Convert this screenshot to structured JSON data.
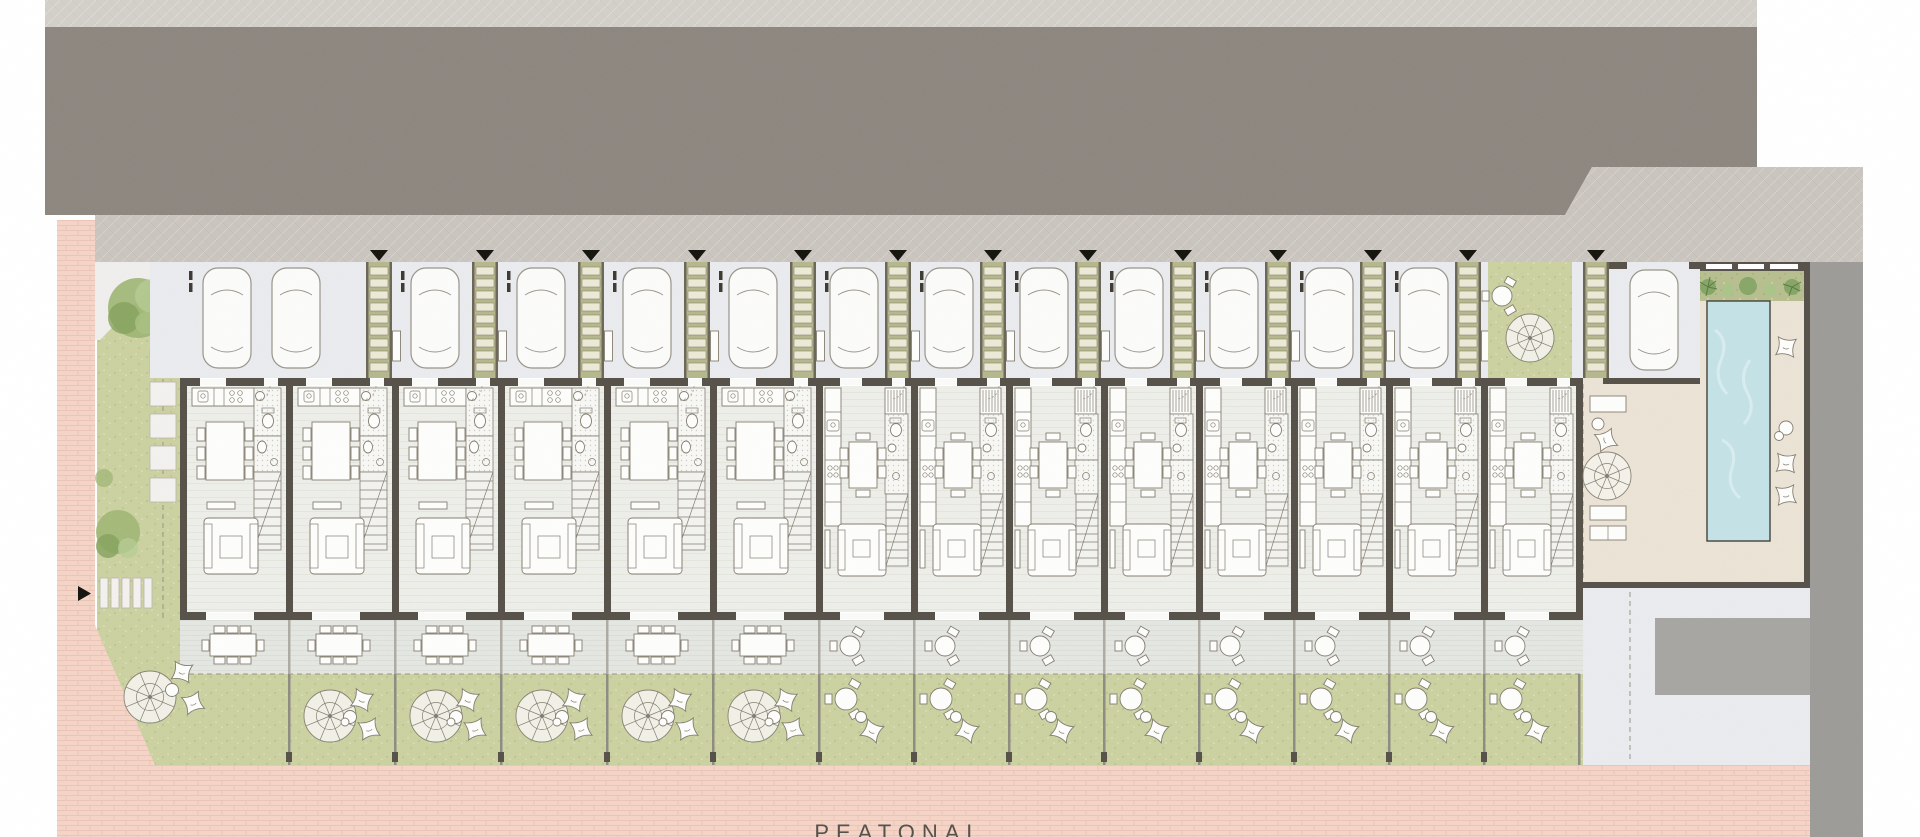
{
  "labels": {
    "pedestrian_street": "PEATONAL"
  },
  "palette": {
    "road_asphalt": "#8d8780",
    "sidewalk": "#cac5be",
    "sidewalk_top": "#d2cdc6",
    "parking": "#e9ebee",
    "walkway_base": "#b5b88c",
    "walkway_slat": "#ece9d6",
    "wall": "#57524a",
    "floor": "#edeee9",
    "bathroom": "#f7f7f4",
    "terrace": "#e4e6e2",
    "grass": "#cbd1a0",
    "planting": "#b7bf90",
    "brick": "#f4d4c6",
    "brick_line": "#e9c0b1",
    "pool": "#c4e2e6",
    "deck": "#ebe3d5",
    "street_right": "#9d9c99",
    "driveway": "#e9ebee",
    "concrete_pad": "#a7a6a2",
    "furniture_line": "#847e71",
    "furniture_fill": "#fdfdfb",
    "tree": "#9db573",
    "marker": "#17150f",
    "label": "#55524c"
  },
  "site": {
    "wide_units": 6,
    "narrow_units": 8,
    "entry_walkways": 13,
    "parked_cars": 14,
    "features": [
      "row-townhouses",
      "private-parking-court",
      "green-entry-walkways",
      "private-terraces",
      "private-gardens",
      "communal-pool",
      "pool-deck",
      "pedestrian-street"
    ]
  }
}
